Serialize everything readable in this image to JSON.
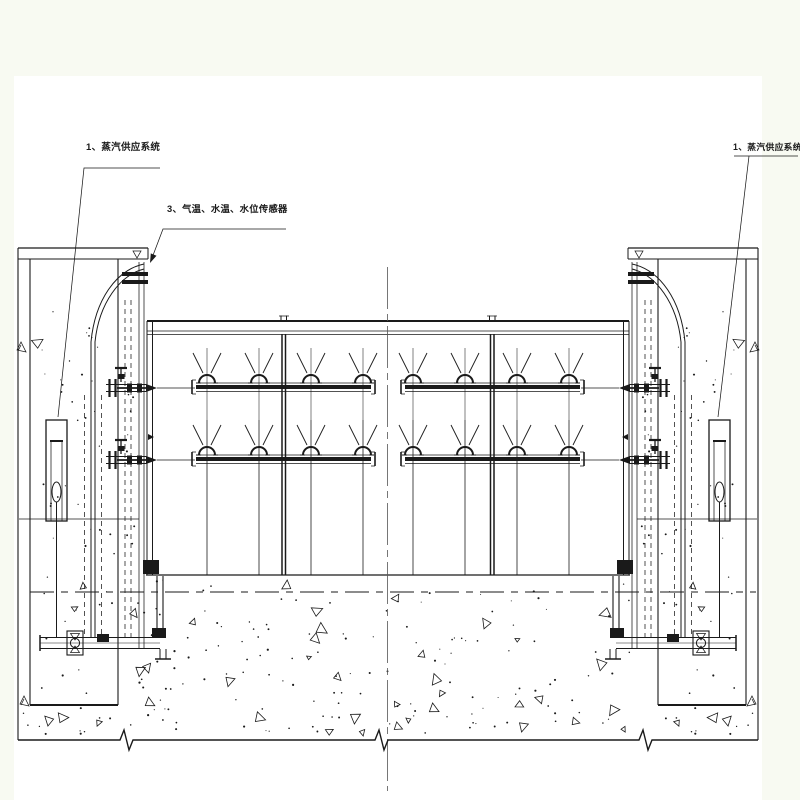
{
  "labels": {
    "left": {
      "text": "1、蒸汽供应系统"
    },
    "middle": {
      "text": "3、气温、水温、水位传感器"
    },
    "right": {
      "text": "1、蒸汽供应系统"
    }
  },
  "colors": {
    "background": "#f8faf2",
    "sheet": "#ffffff",
    "line": "#1a1a1a",
    "centerline": "#555555"
  }
}
